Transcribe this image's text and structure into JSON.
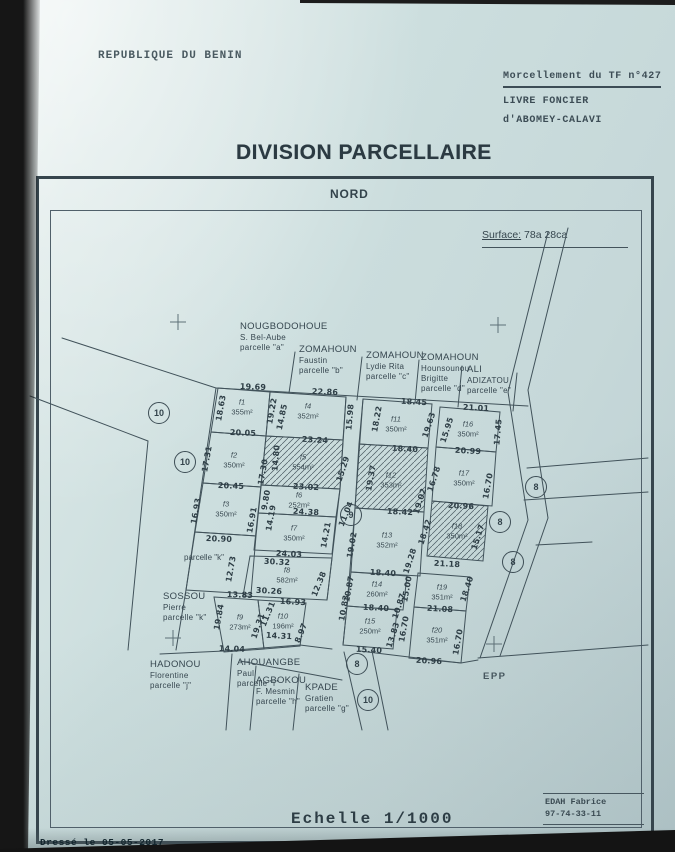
{
  "header": {
    "country": "REPUBLIQUE DU BENIN",
    "ref1": "Morcellement du TF n°427",
    "ref2": "LIVRE FONCIER",
    "ref3": "d'ABOMEY-CALAVI",
    "title": "DIVISION PARCELLAIRE"
  },
  "map": {
    "north": "NORD",
    "surface_label": "Surface:",
    "surface_value": "78a 28ca",
    "epp": "EPP",
    "parcelle_k_note": "parcelle \"k\""
  },
  "footer": {
    "scale": "Echelle 1/1000",
    "surveyor": "EDAH Fabrice",
    "phone": "97-74-33-11",
    "drawn": "Dressé le 05-05-2017"
  },
  "owners": [
    {
      "lines": [
        "NOUGBODOHOUE",
        "S. Bel-Aube",
        "parcelle \"a\""
      ],
      "x": 240,
      "y": 321
    },
    {
      "lines": [
        "ZOMAHOUN",
        "Faustin",
        "parcelle \"b\""
      ],
      "x": 299,
      "y": 344
    },
    {
      "lines": [
        "ZOMAHOUN",
        "Lydie Rita",
        "parcelle \"c\""
      ],
      "x": 366,
      "y": 350
    },
    {
      "lines": [
        "ZOMAHOUN",
        "Hounsounou",
        "Brigitte",
        "parcelle \"d\""
      ],
      "x": 421,
      "y": 352
    },
    {
      "lines": [
        "ALI",
        "ADIZATOU",
        "parcelle \"e\""
      ],
      "x": 467,
      "y": 364
    },
    {
      "lines": [
        "SOSSOU",
        "Pierre",
        "parcelle \"k\""
      ],
      "x": 163,
      "y": 591
    },
    {
      "lines": [
        "HADONOU",
        "Florentine",
        "parcelle \"j\""
      ],
      "x": 150,
      "y": 659
    },
    {
      "lines": [
        "AHOUANGBE",
        "Paul",
        "parcelle \"i\""
      ],
      "x": 237,
      "y": 657
    },
    {
      "lines": [
        "AGBOKOU",
        "F. Mesmin",
        "parcelle \"h\""
      ],
      "x": 256,
      "y": 675
    },
    {
      "lines": [
        "KPADE",
        "Gratien",
        "parcelle \"g\""
      ],
      "x": 305,
      "y": 682
    }
  ],
  "parcels": [
    {
      "id": "f1",
      "area": "355m²",
      "x": 242,
      "y": 407
    },
    {
      "id": "f2",
      "area": "350m²",
      "x": 234,
      "y": 460
    },
    {
      "id": "f3",
      "area": "350m²",
      "x": 226,
      "y": 509
    },
    {
      "id": "f4",
      "area": "352m²",
      "x": 308,
      "y": 411
    },
    {
      "id": "f5",
      "area": "554m²",
      "x": 303,
      "y": 462
    },
    {
      "id": "f6",
      "area": "252m²",
      "x": 299,
      "y": 500
    },
    {
      "id": "f7",
      "area": "350m²",
      "x": 294,
      "y": 533
    },
    {
      "id": "f8",
      "area": "582m²",
      "x": 287,
      "y": 575
    },
    {
      "id": "f9",
      "area": "273m²",
      "x": 240,
      "y": 622
    },
    {
      "id": "f10",
      "area": "196m²",
      "x": 283,
      "y": 621
    },
    {
      "id": "f11",
      "area": "350m²",
      "x": 396,
      "y": 424
    },
    {
      "id": "f12",
      "area": "353m²",
      "x": 391,
      "y": 480
    },
    {
      "id": "f13",
      "area": "352m²",
      "x": 387,
      "y": 540
    },
    {
      "id": "f14",
      "area": "260m²",
      "x": 377,
      "y": 589
    },
    {
      "id": "f15",
      "area": "250m²",
      "x": 370,
      "y": 626
    },
    {
      "id": "f16",
      "area": "350m²",
      "x": 468,
      "y": 429
    },
    {
      "id": "f17",
      "area": "350m²",
      "x": 464,
      "y": 478
    },
    {
      "id": "f18",
      "area": "350m²",
      "x": 457,
      "y": 531
    },
    {
      "id": "f19",
      "area": "351m²",
      "x": 442,
      "y": 592
    },
    {
      "id": "f20",
      "area": "351m²",
      "x": 437,
      "y": 635
    }
  ],
  "measurements": [
    {
      "t": "19.69",
      "x": 253,
      "y": 387,
      "r": 2
    },
    {
      "t": "22.86",
      "x": 325,
      "y": 392,
      "r": 2
    },
    {
      "t": "18.45",
      "x": 414,
      "y": 402,
      "r": 3
    },
    {
      "t": "21.01",
      "x": 476,
      "y": 408,
      "r": 3
    },
    {
      "t": "20.05",
      "x": 243,
      "y": 433,
      "r": 2
    },
    {
      "t": "23.24",
      "x": 315,
      "y": 440,
      "r": 3
    },
    {
      "t": "18.40",
      "x": 405,
      "y": 449,
      "r": 3
    },
    {
      "t": "20.99",
      "x": 468,
      "y": 451,
      "r": 3
    },
    {
      "t": "20.45",
      "x": 231,
      "y": 486,
      "r": 2
    },
    {
      "t": "23.02",
      "x": 306,
      "y": 487,
      "r": 3
    },
    {
      "t": "24.38",
      "x": 306,
      "y": 512,
      "r": 3
    },
    {
      "t": "18.42",
      "x": 400,
      "y": 512,
      "r": 3
    },
    {
      "t": "20.96",
      "x": 461,
      "y": 506,
      "r": 3
    },
    {
      "t": "20.90",
      "x": 219,
      "y": 539,
      "r": 2
    },
    {
      "t": "24.03",
      "x": 289,
      "y": 554,
      "r": 3
    },
    {
      "t": "30.32",
      "x": 277,
      "y": 562,
      "r": 3
    },
    {
      "t": "21.18",
      "x": 447,
      "y": 564,
      "r": 3
    },
    {
      "t": "30.26",
      "x": 269,
      "y": 591,
      "r": 3
    },
    {
      "t": "18.40",
      "x": 383,
      "y": 573,
      "r": 3
    },
    {
      "t": "13.83",
      "x": 240,
      "y": 595,
      "r": 2
    },
    {
      "t": "16.93",
      "x": 293,
      "y": 602,
      "r": 3
    },
    {
      "t": "18.40",
      "x": 376,
      "y": 608,
      "r": 3
    },
    {
      "t": "21.08",
      "x": 440,
      "y": 609,
      "r": 3
    },
    {
      "t": "14.31",
      "x": 279,
      "y": 636,
      "r": 3
    },
    {
      "t": "14.04",
      "x": 232,
      "y": 649,
      "r": 2
    },
    {
      "t": "15.40",
      "x": 369,
      "y": 650,
      "r": 3
    },
    {
      "t": "20.96",
      "x": 429,
      "y": 661,
      "r": 3
    },
    {
      "t": "18.63",
      "x": 221,
      "y": 408,
      "r": -80
    },
    {
      "t": "19.22",
      "x": 272,
      "y": 411,
      "r": -80
    },
    {
      "t": "14.85",
      "x": 282,
      "y": 417,
      "r": -78
    },
    {
      "t": "15.98",
      "x": 350,
      "y": 417,
      "r": -85
    },
    {
      "t": "18.22",
      "x": 377,
      "y": 419,
      "r": -80
    },
    {
      "t": "19.63",
      "x": 429,
      "y": 425,
      "r": -72
    },
    {
      "t": "15.95",
      "x": 447,
      "y": 430,
      "r": -72
    },
    {
      "t": "17.45",
      "x": 498,
      "y": 432,
      "r": -85
    },
    {
      "t": "17.31",
      "x": 207,
      "y": 459,
      "r": -80
    },
    {
      "t": "14.80",
      "x": 276,
      "y": 458,
      "r": -85
    },
    {
      "t": "17.30",
      "x": 263,
      "y": 472,
      "r": -80
    },
    {
      "t": "15.29",
      "x": 343,
      "y": 469,
      "r": -72
    },
    {
      "t": "9.80",
      "x": 266,
      "y": 500,
      "r": -80
    },
    {
      "t": "16.78",
      "x": 434,
      "y": 479,
      "r": -72
    },
    {
      "t": "19.02",
      "x": 420,
      "y": 501,
      "r": -72
    },
    {
      "t": "16.70",
      "x": 488,
      "y": 486,
      "r": -80
    },
    {
      "t": "16.93",
      "x": 196,
      "y": 511,
      "r": -80
    },
    {
      "t": "16.91",
      "x": 252,
      "y": 520,
      "r": -80
    },
    {
      "t": "14.19",
      "x": 271,
      "y": 518,
      "r": -80
    },
    {
      "t": "11.04",
      "x": 346,
      "y": 514,
      "r": -68
    },
    {
      "t": "19.37",
      "x": 371,
      "y": 478,
      "r": -80
    },
    {
      "t": "14.21",
      "x": 326,
      "y": 535,
      "r": -80
    },
    {
      "t": "15.17",
      "x": 478,
      "y": 537,
      "r": -72
    },
    {
      "t": "19.02",
      "x": 352,
      "y": 545,
      "r": -80
    },
    {
      "t": "18.42",
      "x": 425,
      "y": 532,
      "r": -72
    },
    {
      "t": "19.28",
      "x": 410,
      "y": 561,
      "r": -72
    },
    {
      "t": "12.73",
      "x": 231,
      "y": 569,
      "r": -80
    },
    {
      "t": "12.38",
      "x": 319,
      "y": 584,
      "r": -68
    },
    {
      "t": "10.87",
      "x": 349,
      "y": 589,
      "r": -80
    },
    {
      "t": "15.00",
      "x": 407,
      "y": 589,
      "r": -80
    },
    {
      "t": "10.87",
      "x": 399,
      "y": 606,
      "r": -72
    },
    {
      "t": "18.40",
      "x": 467,
      "y": 589,
      "r": -72
    },
    {
      "t": "19.84",
      "x": 219,
      "y": 617,
      "r": -80
    },
    {
      "t": "19.31",
      "x": 258,
      "y": 626,
      "r": -72
    },
    {
      "t": "11.31",
      "x": 268,
      "y": 614,
      "r": -68
    },
    {
      "t": "8.97",
      "x": 301,
      "y": 633,
      "r": -68
    },
    {
      "t": "10.83",
      "x": 344,
      "y": 608,
      "r": -80
    },
    {
      "t": "13.83",
      "x": 393,
      "y": 635,
      "r": -72
    },
    {
      "t": "16.70",
      "x": 404,
      "y": 629,
      "r": -80
    },
    {
      "t": "16.70",
      "x": 458,
      "y": 642,
      "r": -80
    }
  ],
  "road_nodes": [
    {
      "n": "10",
      "x": 159,
      "y": 413
    },
    {
      "n": "10",
      "x": 185,
      "y": 462
    },
    {
      "n": "9",
      "x": 351,
      "y": 515
    },
    {
      "n": "8",
      "x": 536,
      "y": 487
    },
    {
      "n": "8",
      "x": 500,
      "y": 522
    },
    {
      "n": "8",
      "x": 513,
      "y": 562
    },
    {
      "n": "8",
      "x": 357,
      "y": 664
    },
    {
      "n": "10",
      "x": 368,
      "y": 700
    }
  ]
}
